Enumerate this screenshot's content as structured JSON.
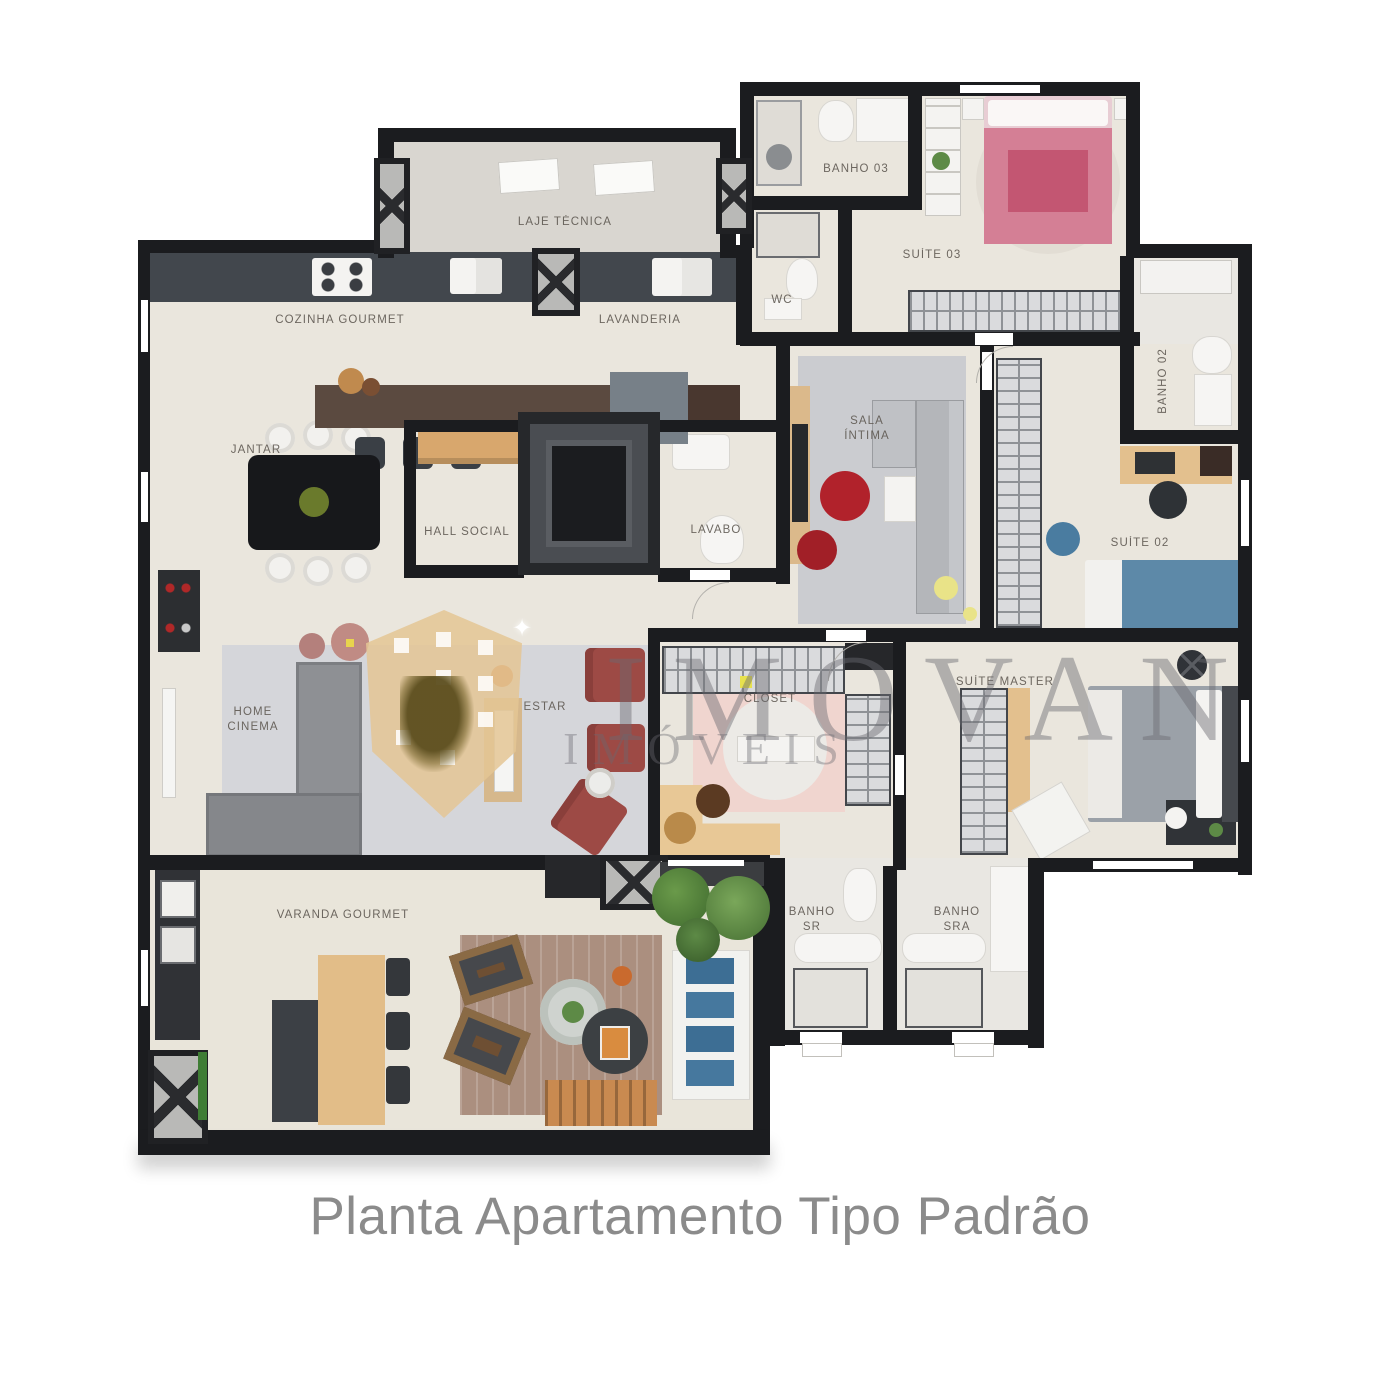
{
  "page": {
    "caption": "Planta Apartamento Tipo Padrão",
    "background_color": "#ffffff",
    "caption_color": "#8b8b8b"
  },
  "watermark": {
    "brand": "IMOVAN",
    "subtitle": "IMÓVEIS"
  },
  "rooms": {
    "laje_tecnica": {
      "label": "LAJE TÉCNICA"
    },
    "cozinha_gourmet": {
      "label": "COZINHA GOURMET"
    },
    "lavanderia": {
      "label": "LAVANDERIA"
    },
    "jantar": {
      "label": "JANTAR"
    },
    "hall_social": {
      "label": "HALL SOCIAL"
    },
    "lavabo": {
      "label": "LAVABO"
    },
    "wc": {
      "label": "WC"
    },
    "banho_03": {
      "label": "BANHO 03"
    },
    "suite_03": {
      "label": "SUÍTE 03"
    },
    "banho_02": {
      "label": "BANHO 02"
    },
    "suite_02": {
      "label": "SUÍTE 02"
    },
    "sala_intima": {
      "line1": "SALA",
      "line2": "ÍNTIMA"
    },
    "home_cinema": {
      "line1": "HOME",
      "line2": "CINEMA"
    },
    "estar": {
      "label": "ESTAR"
    },
    "closet": {
      "label": "CLOSET"
    },
    "suite_master": {
      "label": "SUÍTE MASTER"
    },
    "varanda_gourmet": {
      "label": "VARANDA GOURMET"
    },
    "banho_sr": {
      "line1": "BANHO",
      "line2": "SR"
    },
    "banho_sra": {
      "line1": "BANHO",
      "line2": "SRA"
    }
  },
  "colors": {
    "wall": "#1b1c1f",
    "floor": "#eae6dd",
    "bed_suite03_pink": "#d47f95",
    "bed_suite02_blue": "#5d89a8",
    "bed_master_gray": "#9ba1a8",
    "pouf_red": "#b1222b",
    "armchair_red": "#9d4a45",
    "counter_brown": "#5b4a40",
    "sofa_cushion_blue": "#3d6e94",
    "caption_gray": "#8b8b8b",
    "watermark_gray": "#74747a"
  }
}
